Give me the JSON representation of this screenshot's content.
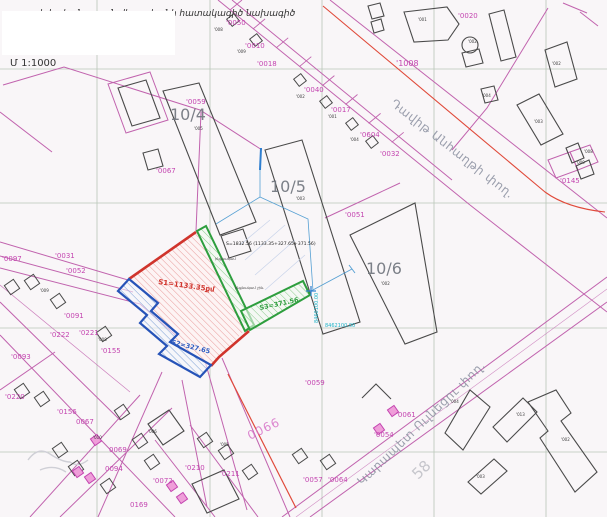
{
  "document": {
    "scale_label": "Մ 1:1000",
    "title_clipped": "սեփականության վկայականի հատակագիծ նախագիծ",
    "area_summary": "S=1832.56 (1133.35+327.65+371.56)",
    "parcel_areas": {
      "s1": "S1=1133.35քմ",
      "s2": "S2=327.65",
      "s3": "S3=371.56"
    },
    "coordinates": {
      "vertical": "8460100.00",
      "horizontal": "8462100.00"
    },
    "streets": [
      "Դավիթ Անհաղթի փող.",
      "Կարապետ Ուլնեցու փող."
    ],
    "blocks": [
      "10/4",
      "10/5",
      "10/6"
    ],
    "colors": {
      "magenta": "#c445b0",
      "red": "#d0342c",
      "blue": "#2f5fc4",
      "green": "#2e9e3e",
      "cyan": "#1fb4c8"
    }
  },
  "map_labels": [
    {
      "t": "սեփականության վկայականի հատակագիծ նախագիծ",
      "x": 34,
      "y": 16,
      "cls": "titleclip",
      "name": "clipped-title"
    },
    {
      "t": "Մ 1:1000",
      "x": 10,
      "y": 66,
      "cls": "scale",
      "name": "scale-label"
    },
    {
      "t": "10/4",
      "x": 170,
      "y": 120,
      "cls": "big",
      "name": "block-number"
    },
    {
      "t": "10/5",
      "x": 270,
      "y": 192,
      "cls": "big",
      "name": "block-number"
    },
    {
      "t": "10/6",
      "x": 366,
      "y": 274,
      "cls": "big",
      "name": "block-number"
    },
    {
      "t": "'0059",
      "x": 186,
      "y": 104,
      "cls": "m"
    },
    {
      "t": "'0050",
      "x": 226,
      "y": 25,
      "cls": "m"
    },
    {
      "t": "'0010",
      "x": 245,
      "y": 48,
      "cls": "m"
    },
    {
      "t": "'0018",
      "x": 257,
      "y": 66,
      "cls": "m"
    },
    {
      "t": "'0040",
      "x": 304,
      "y": 92,
      "cls": "m"
    },
    {
      "t": "'0017",
      "x": 331,
      "y": 112,
      "cls": "m"
    },
    {
      "t": "'0604",
      "x": 360,
      "y": 137,
      "cls": "m"
    },
    {
      "t": "'0032",
      "x": 380,
      "y": 156,
      "cls": "m"
    },
    {
      "t": "'0020",
      "x": 458,
      "y": 18,
      "cls": "m"
    },
    {
      "t": "'1008",
      "x": 396,
      "y": 66,
      "cls": "m8"
    },
    {
      "t": "'0145",
      "x": 560,
      "y": 183,
      "cls": "m"
    },
    {
      "t": "'0051",
      "x": 345,
      "y": 217,
      "cls": "m"
    },
    {
      "t": "'0097",
      "x": 2,
      "y": 261,
      "cls": "m"
    },
    {
      "t": "'0031",
      "x": 55,
      "y": 258,
      "cls": "m"
    },
    {
      "t": "'0052",
      "x": 66,
      "y": 273,
      "cls": "m"
    },
    {
      "t": "'0091",
      "x": 64,
      "y": 318,
      "cls": "m"
    },
    {
      "t": "'0222",
      "x": 50,
      "y": 337,
      "cls": "m"
    },
    {
      "t": "'0221",
      "x": 79,
      "y": 335,
      "cls": "m"
    },
    {
      "t": "'0155",
      "x": 101,
      "y": 353,
      "cls": "m"
    },
    {
      "t": "'0093",
      "x": 11,
      "y": 359,
      "cls": "m"
    },
    {
      "t": "'0220",
      "x": 5,
      "y": 399,
      "cls": "m"
    },
    {
      "t": "'0156",
      "x": 57,
      "y": 414,
      "cls": "m"
    },
    {
      "t": "0067",
      "x": 76,
      "y": 424,
      "cls": "m"
    },
    {
      "t": "0069",
      "x": 109,
      "y": 452,
      "cls": "m"
    },
    {
      "t": "0094",
      "x": 105,
      "y": 471,
      "cls": "m"
    },
    {
      "t": "0169",
      "x": 130,
      "y": 507,
      "cls": "m"
    },
    {
      "t": "'0072",
      "x": 153,
      "y": 483,
      "cls": "m"
    },
    {
      "t": "'0210",
      "x": 185,
      "y": 470,
      "cls": "m"
    },
    {
      "t": "'0211",
      "x": 220,
      "y": 476,
      "cls": "m"
    },
    {
      "t": "'0057",
      "x": 303,
      "y": 482,
      "cls": "m"
    },
    {
      "t": "'0064",
      "x": 328,
      "y": 482,
      "cls": "m"
    },
    {
      "t": "'0059",
      "x": 305,
      "y": 385,
      "cls": "m"
    },
    {
      "t": "'0061",
      "x": 396,
      "y": 417,
      "cls": "m"
    },
    {
      "t": "'0054",
      "x": 374,
      "y": 437,
      "cls": "m"
    },
    {
      "t": "'0067",
      "x": 156,
      "y": 173,
      "cls": "m"
    },
    {
      "t": "0066",
      "x": 250,
      "y": 440,
      "cls": "pinkbig",
      "rot": -26,
      "name": "street-parcel-number"
    },
    {
      "t": "'008",
      "x": 214,
      "y": 31,
      "cls": "tiny"
    },
    {
      "t": "'009",
      "x": 237,
      "y": 53,
      "cls": "tiny"
    },
    {
      "t": "'002",
      "x": 296,
      "y": 98,
      "cls": "tiny"
    },
    {
      "t": "'001",
      "x": 328,
      "y": 118,
      "cls": "tiny"
    },
    {
      "t": "'004",
      "x": 350,
      "y": 141,
      "cls": "tiny"
    },
    {
      "t": "'001",
      "x": 418,
      "y": 21,
      "cls": "tiny"
    },
    {
      "t": "'002",
      "x": 468,
      "y": 43,
      "cls": "tiny"
    },
    {
      "t": "'004",
      "x": 482,
      "y": 97,
      "cls": "tiny"
    },
    {
      "t": "'002",
      "x": 552,
      "y": 65,
      "cls": "tiny"
    },
    {
      "t": "'003",
      "x": 534,
      "y": 123,
      "cls": "tiny"
    },
    {
      "t": "'008",
      "x": 584,
      "y": 153,
      "cls": "tiny"
    },
    {
      "t": "'009",
      "x": 576,
      "y": 164,
      "cls": "tiny"
    },
    {
      "t": "'002",
      "x": 381,
      "y": 285,
      "cls": "tiny"
    },
    {
      "t": "'005",
      "x": 194,
      "y": 130,
      "cls": "tiny"
    },
    {
      "t": "'003",
      "x": 296,
      "y": 200,
      "cls": "tiny"
    },
    {
      "t": "'004",
      "x": 450,
      "y": 403,
      "cls": "tiny"
    },
    {
      "t": "'013",
      "x": 516,
      "y": 416,
      "cls": "tiny"
    },
    {
      "t": "'002",
      "x": 561,
      "y": 441,
      "cls": "tiny"
    },
    {
      "t": "'003",
      "x": 476,
      "y": 478,
      "cls": "tiny"
    },
    {
      "t": "'009",
      "x": 40,
      "y": 292,
      "cls": "tiny"
    },
    {
      "t": "'008",
      "x": 98,
      "y": 341,
      "cls": "tiny"
    },
    {
      "t": "'005",
      "x": 220,
      "y": 446,
      "cls": "tiny"
    },
    {
      "t": "'006",
      "x": 148,
      "y": 433,
      "cls": "tiny"
    },
    {
      "t": "'010",
      "x": 93,
      "y": 439,
      "cls": "tiny"
    },
    {
      "t": "S=1832.56 (1133.35+327.65+371.56)",
      "x": 226,
      "y": 245,
      "cls": "dim",
      "name": "area-summary"
    },
    {
      "t": "ինքնակամ",
      "x": 215,
      "y": 260,
      "cls": "dim2"
    },
    {
      "t": "ինքնակամ շին.",
      "x": 235,
      "y": 289,
      "cls": "dim2"
    },
    {
      "t": "S1=1133.35քմ",
      "x": 158,
      "y": 284,
      "cls": "red",
      "rot": 8,
      "name": "parcel-area-s1"
    },
    {
      "t": "S2=327.65",
      "x": 171,
      "y": 344,
      "cls": "blue",
      "rot": 14,
      "name": "parcel-area-s2"
    },
    {
      "t": "S3=371.56",
      "x": 260,
      "y": 310,
      "cls": "green",
      "rot": -12,
      "name": "parcel-area-s3"
    },
    {
      "t": "8460100.00",
      "x": 318,
      "y": 323,
      "cls": "cyan",
      "rot": -90,
      "name": "grid-coordinate"
    },
    {
      "t": "8462100.00",
      "x": 325,
      "y": 327,
      "cls": "cyan",
      "name": "grid-coordinate"
    },
    {
      "t": "Դավիթ Անհաղթի փող.",
      "x": 390,
      "y": 105,
      "cls": "street",
      "rot": 38,
      "name": "street-name"
    },
    {
      "t": "Կարապետ Ուլնեցու փող.",
      "x": 362,
      "y": 486,
      "cls": "street",
      "rot": -44,
      "name": "street-name"
    },
    {
      "t": "58",
      "x": 418,
      "y": 480,
      "cls": "wm",
      "rot": -44,
      "name": "watermark-number"
    }
  ]
}
